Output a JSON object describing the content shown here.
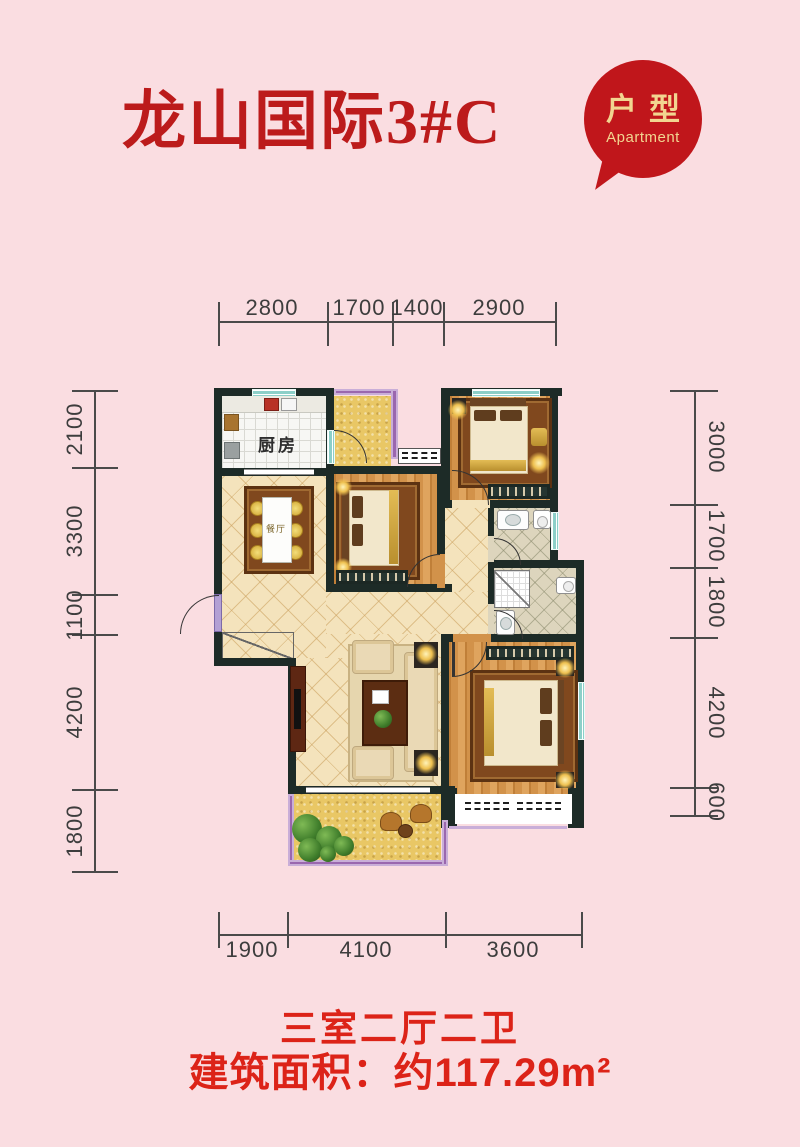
{
  "header": {
    "title": "龙山国际3#C",
    "badge_line1": "户型",
    "badge_line2": "Apartment"
  },
  "plan": {
    "labels": {
      "kitchen": "厨房",
      "dining": "餐厅"
    },
    "icons": {
      "door_swing": "quarter-arc",
      "window": "teal-striped-band",
      "railing": "purple-band",
      "bed": "rug-bordered-bed",
      "plant": "green-circle-cluster"
    }
  },
  "dims": {
    "top": [
      "2800",
      "1700",
      "1400",
      "2900"
    ],
    "left": [
      "2100",
      "3300",
      "1100",
      "4200",
      "1800"
    ],
    "right": [
      "3000",
      "1700",
      "1800",
      "4200",
      "600"
    ],
    "bottom": [
      "1900",
      "4100",
      "3600"
    ]
  },
  "footer": {
    "rooms": "三室二厅二卫",
    "area": "建筑面积：约117.29m²"
  },
  "colors": {
    "background_pink": "#fadde1",
    "title_red": "#bc1b1b",
    "footer_red": "#dc2318",
    "bubble_red": "#c0161b",
    "bubble_gold": "#f2d590",
    "wall_dark": "#1d2b27",
    "window_teal": "#8ccfc8",
    "railing_purple": "#9a67ae",
    "wood_floor": "#d2924a",
    "tile_tan": "#f4e3bc",
    "balcony_yellow": "#e9c765",
    "dim_text": "#3d3d3d"
  }
}
